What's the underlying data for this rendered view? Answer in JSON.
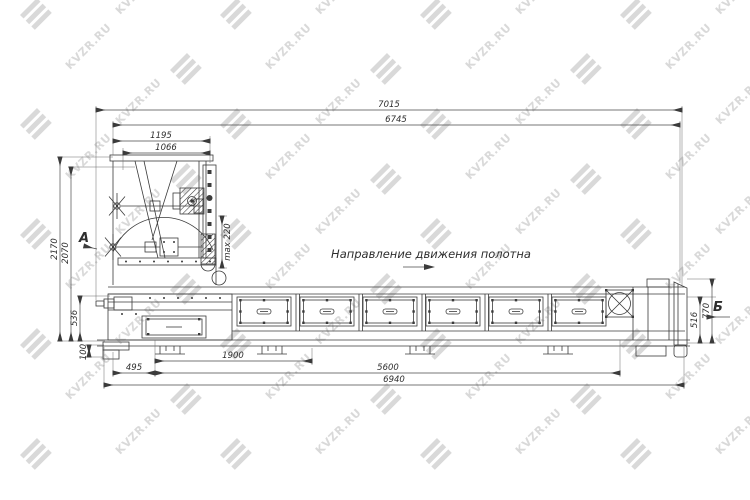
{
  "watermark": {
    "text": "KVZR.RU"
  },
  "drawing": {
    "direction_note": "Направление движения полотна",
    "view_labels": {
      "a": "А",
      "b": "Б"
    },
    "dimensions": {
      "overall_length": "7015",
      "frame_length": "6745",
      "head_width_outer": "1195",
      "head_width_inner": "1066",
      "overall_height": "2170",
      "head_height": "2070",
      "belt_height_left": "536",
      "ground_clearance": "100",
      "screw_travel": "max 220",
      "belt_height_right": "516",
      "end_height": "770",
      "leg_offset": "495",
      "drive_section_length": "1900",
      "support_span": "5600",
      "frame_base_length": "6940"
    }
  }
}
